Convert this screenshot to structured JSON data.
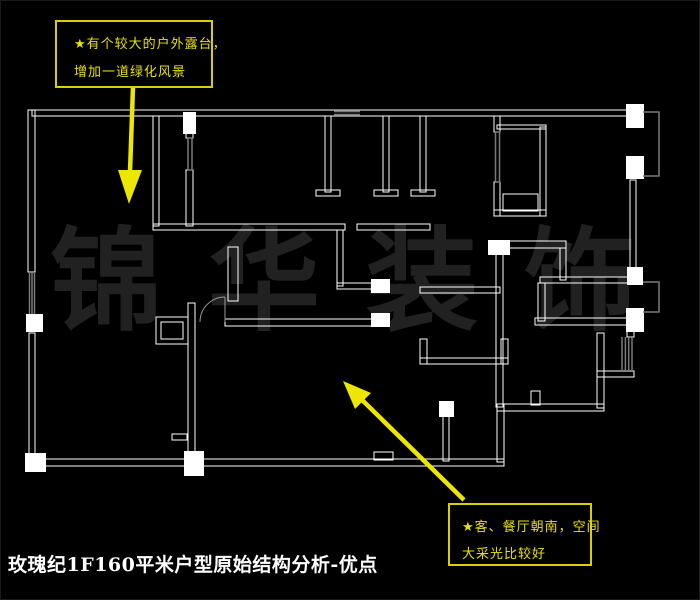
{
  "title": "玫瑰纪1F160平米户型原始结构分析-优点",
  "watermark": {
    "text": "锦华装饰"
  },
  "annotations": [
    {
      "id": "terrace-note",
      "lines": [
        "★有个较大的户外露台，",
        "增加一道绿化风景"
      ]
    },
    {
      "id": "living-note",
      "lines": [
        "★客、餐厅朝南，空间",
        "大采光比较好"
      ]
    }
  ],
  "colors": {
    "background": "#000000",
    "wall": "#ffffff",
    "window_gray": "#7a7a7a",
    "annotation_yellow": "#e9e200",
    "arrow_yellow": "#ece600",
    "watermark_gray": "#212121",
    "title_white": "#ffffff"
  }
}
